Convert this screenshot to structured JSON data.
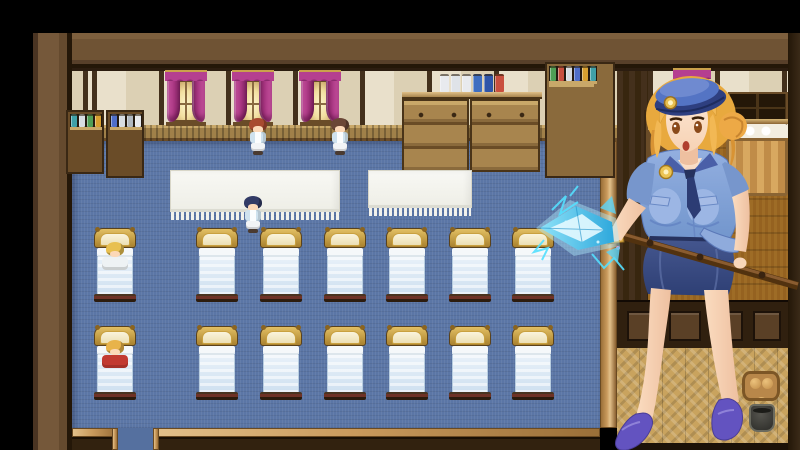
{
  "scene": {
    "name": "dormitory-room",
    "description": "Top-down RPG dormitory with two rows of beds on a blue carpet, windows with magenta curtains, potion shelves, nurse NPCs, and a giant policewoman event portrait holding an ice-crystal spear staff",
    "palette": {
      "background": "#000000",
      "outer_wall": "#6f5334",
      "wall_cream": "#e9e0cb",
      "wall_post": "#43301c",
      "wainscot": "#a08049",
      "carpet_blue": "#5b76a6",
      "gold_trim": "#c99a5c",
      "curtain_magenta": "#b53f90",
      "window_glow": "#f2dfa0",
      "bed_frame_gold": "#c9a140",
      "bed_blanket": "#d9e8f4",
      "table_cloth": "#f4f4ee",
      "divider_wall": "#44301c",
      "tatami": "#c9a662",
      "herringbone": "#c9a35e"
    },
    "windows": [
      {
        "x": 166,
        "y": 70
      },
      {
        "x": 233,
        "y": 70
      },
      {
        "x": 300,
        "y": 70
      }
    ],
    "right_room_curtain": {
      "x": 674,
      "y": 68
    },
    "beds": {
      "columns_x": [
        94,
        196,
        260,
        324,
        386,
        449,
        512
      ],
      "rows_y": [
        228,
        326
      ],
      "occupants": [
        {
          "row": 0,
          "col": 0,
          "name": "sleeping-patient-blonde",
          "hair": "#e8c050",
          "blanket_body": "#eef2f4"
        },
        {
          "row": 1,
          "col": 0,
          "name": "sleeping-patient-red",
          "hair": "#e8b34a",
          "blanket_body": "#c23a32"
        }
      ]
    },
    "tables": [
      {
        "x": 170,
        "y": 170,
        "w": 170,
        "h": 42
      },
      {
        "x": 368,
        "y": 170,
        "w": 104,
        "h": 38
      }
    ],
    "npcs": [
      {
        "name": "npc-girl-auburn",
        "x": 247,
        "y": 118,
        "hair": "#a84a30",
        "top": "#cfe2ee",
        "skirt": "#f2f4f6"
      },
      {
        "name": "npc-girl-brunette",
        "x": 329,
        "y": 118,
        "hair": "#6b4636",
        "top": "#cfe2ee",
        "skirt": "#f2f4f6"
      },
      {
        "name": "npc-girl-navy",
        "x": 242,
        "y": 196,
        "hair": "#323b66",
        "top": "#cfe2ee",
        "skirt": "#f2f4f6"
      }
    ],
    "left_shelf_jars": {
      "unit1": [
        "#d8dde2",
        "#c94f3e",
        "#4f9e55",
        "#4f6ec9",
        "#e0e4e8",
        "#d8a030",
        "#c94f3e",
        "#8f5fc9",
        "#3fa0a8",
        "#d8dde2",
        "#4f9e55",
        "#d8a030"
      ],
      "unit2": [
        "#e8eaee",
        "#b0b8c0",
        "#d8dde2",
        "#e8eaee",
        "#4f6ec9",
        "#d8dde2",
        "#b0b8c0",
        "#e8eaee"
      ]
    },
    "counter_items": [
      "#e8eaee",
      "#dfe3e8",
      "#e8eaee",
      "#3f6ec0",
      "#2f55a8",
      "#c94f3e"
    ],
    "apothecary_top": [
      "#2f55a8",
      "#3f6ec0",
      "#c94f3e",
      "#e8eaee",
      "#d8a030"
    ],
    "apothecary_jars": [
      "#c94f3e",
      "#4f9e55",
      "#4f6ec9",
      "#d8a030",
      "#3fa0a8",
      "#8f5fc9",
      "#4f9e55",
      "#c94f3e",
      "#d8dde2",
      "#4f6ec9",
      "#d8a030",
      "#3fa0a8"
    ],
    "right_room_jars": [
      "#4f9e55",
      "#c94f3e",
      "#4f6ec9",
      "#d8a030",
      "#d8dde2",
      "#3fa0a8",
      "#c94f3e",
      "#4f9e55"
    ]
  },
  "overlay": {
    "name": "policewoman-portrait",
    "description": "Blonde anime policewoman in a light blue uniform shirt with navy tie, gold badge, blue cap with gold emblem, navy pencil skirt and purple high heels, holding a long brown staff tipped with a glowing ice-crystal spearhead crackling with cyan lightning",
    "colors": {
      "hair": "#efb452",
      "skin": "#f8d6ba",
      "shirt": "#8fabdc",
      "shirt_shadow": "#6585c2",
      "tie": "#2c3c74",
      "skirt": "#3a4c86",
      "cap": "#4a66b4",
      "badge_gold": "#e8c050",
      "heels": "#6353c0",
      "staff": "#6b4423",
      "ice": "#54c8ee",
      "lightning": "#55e0ff"
    }
  }
}
